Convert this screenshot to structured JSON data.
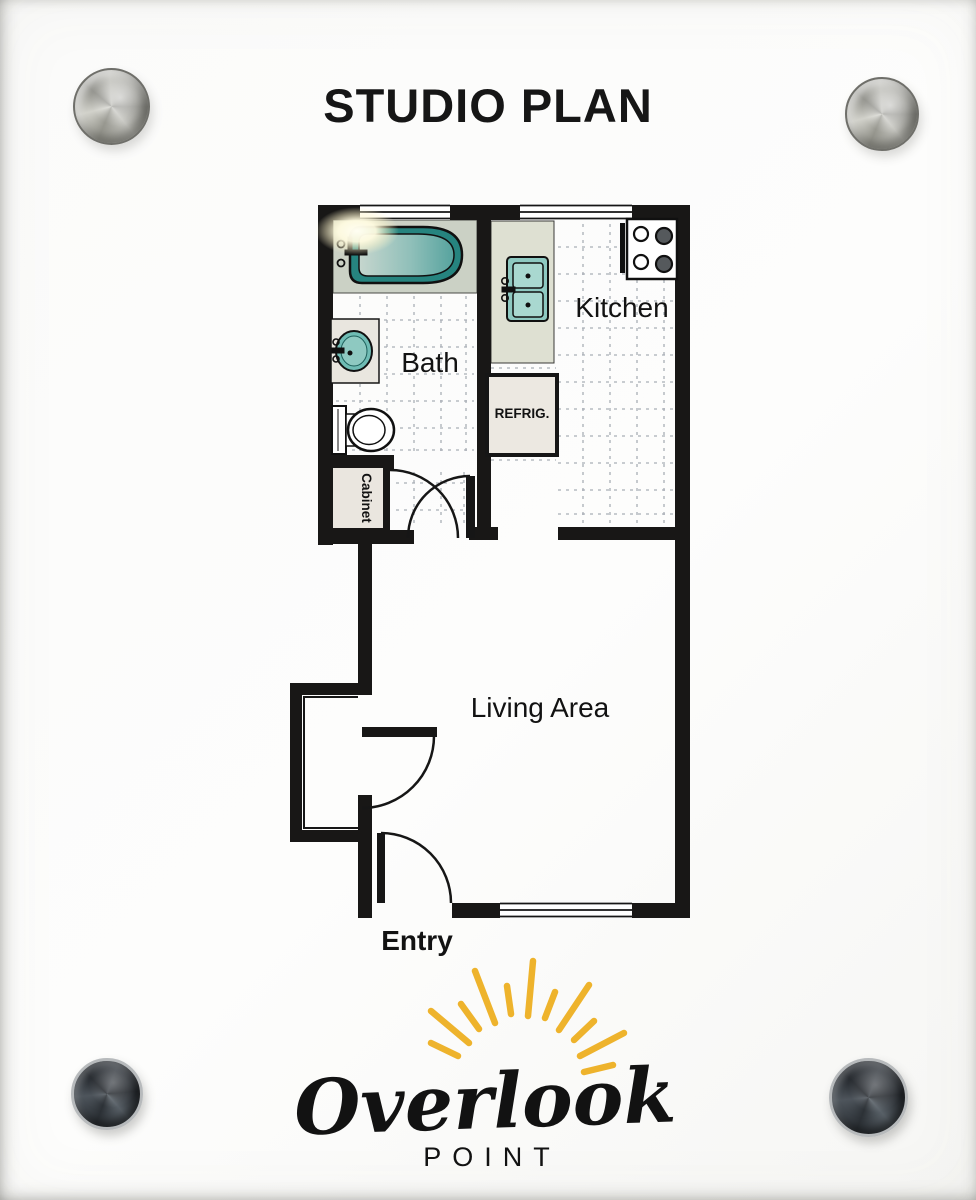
{
  "sign": {
    "title": "STUDIO PLAN",
    "labels": {
      "bath": "Bath",
      "kitchen": "Kitchen",
      "refrig": "REFRIG.",
      "cabinet": "Cabinet",
      "living_area": "Living Area",
      "entry": "Entry"
    },
    "logo": {
      "brand": "Overlook",
      "brand_sub": "POINT"
    }
  },
  "colors": {
    "wall_black": "#181716",
    "tub_teal": "#26847f",
    "fixture_teal_light": "#8ec9c1",
    "counter_gray": "#dee0d2",
    "surround_gray": "#cbd1c5",
    "refrig_fill": "#ece8e1",
    "tile_line": "#a9aeb6",
    "logo_teal": "#4aa9a2",
    "logo_gold": "#eeb32c"
  }
}
